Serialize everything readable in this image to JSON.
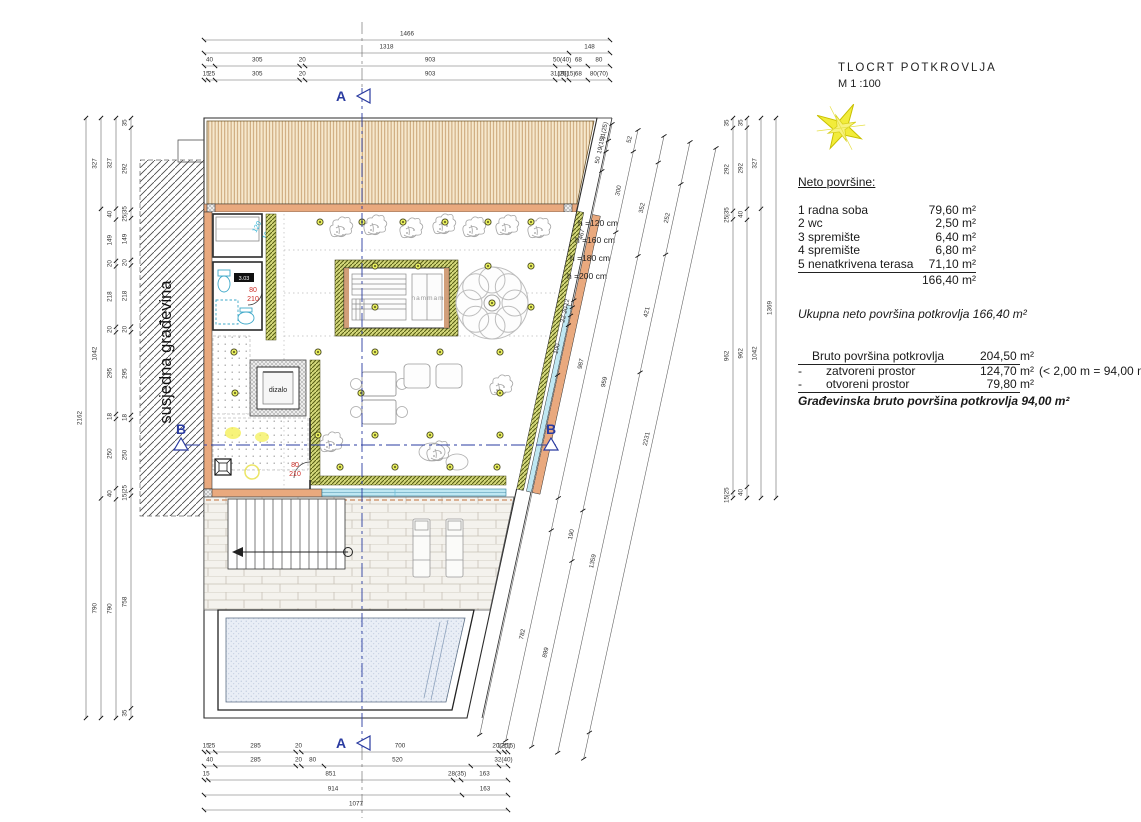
{
  "title_block": {
    "title": "TLOCRT POTKROVLJA",
    "scale": "M 1 :100"
  },
  "neto": {
    "heading": "Neto površine:",
    "rows": [
      {
        "name": "1 radna soba",
        "value": "79,60 m²"
      },
      {
        "name": "2 wc",
        "value": "2,50 m²"
      },
      {
        "name": "3 spremište",
        "value": "6,40 m²"
      },
      {
        "name": "4 spremište",
        "value": "6,80 m²"
      },
      {
        "name": "5 nenatkrivena terasa",
        "value": "71,10 m²"
      }
    ],
    "total": "166,40 m²",
    "summary": "Ukupna neto površina  potkrovlja  166,40 m²"
  },
  "bruto": {
    "rows": [
      {
        "bullet": "",
        "name": "Bruto površina potkrovlja",
        "value": "204,50 m²",
        "note": ""
      },
      {
        "bullet": "-",
        "name": "zatvoreni prostor",
        "value": "124,70 m²",
        "note": "(< 2,00 m = 94,00 m²)"
      },
      {
        "bullet": "-",
        "name": "otvoreni prostor",
        "value": "79,80 m²",
        "note": ""
      }
    ],
    "final": "Građevinska bruto površina potkrovlja  94,00 m²"
  },
  "plan": {
    "labels": {
      "neighbor": "susjedna građevina",
      "elevator": "dizalo",
      "hammam": "hammam",
      "room_no": "3.03",
      "door1_w": "80",
      "door1_h": "210",
      "door2_w": "80",
      "door2_h": "210",
      "window_w": "120",
      "window_h": "100"
    },
    "heights": [
      "h =120 cm",
      "h =160 cm",
      "h =180 cm",
      "h =200 cm"
    ],
    "sections": {
      "a": "A",
      "b": "B"
    }
  },
  "colors": {
    "wall_orange": "#e9a97e",
    "wall_green": "#d5d97c",
    "glass_cyan": "#bfe7f2",
    "section_blue": "#2a3ba0",
    "door_red": "#cc2b24",
    "light_yellow": "#e8ef5e",
    "star_yellow": "#f2ec3a"
  },
  "dims": {
    "top": [
      {
        "segs": [
          [
            "1466",
            1466
          ]
        ]
      },
      {
        "segs": [
          [
            "1318",
            1318
          ],
          [
            "148",
            148
          ]
        ]
      },
      {
        "segs": [
          [
            "40",
            40
          ],
          [
            "305",
            305
          ],
          [
            "20",
            20
          ],
          [
            "903",
            903
          ],
          [
            "50(40)",
            50
          ],
          [
            "68",
            68
          ],
          [
            "80",
            80
          ]
        ]
      },
      {
        "segs": [
          [
            "15",
            15
          ],
          [
            "25",
            25
          ],
          [
            "305",
            305
          ],
          [
            "20",
            20
          ],
          [
            "903",
            903
          ],
          [
            "31(25)",
            31
          ],
          [
            "19(15)",
            19
          ],
          [
            "68",
            68
          ],
          [
            "80(70)",
            80
          ]
        ]
      }
    ],
    "bottom": [
      {
        "segs": [
          [
            "15",
            15
          ],
          [
            "25",
            25
          ],
          [
            "285",
            285
          ],
          [
            "20",
            20
          ],
          [
            "700",
            700
          ],
          [
            "20(25)",
            20
          ],
          [
            "12(15)",
            13
          ]
        ]
      },
      {
        "segs": [
          [
            "40",
            40
          ],
          [
            "285",
            285
          ],
          [
            "20",
            20
          ],
          [
            "80",
            80
          ],
          [
            "520",
            520
          ],
          [
            "",
            100
          ],
          [
            "32(40)",
            32
          ]
        ]
      },
      {
        "segs": [
          [
            "15",
            15
          ],
          [
            "851",
            851
          ],
          [
            "28(35)",
            28
          ],
          [
            "163",
            163
          ]
        ]
      },
      {
        "segs": [
          [
            "914",
            914
          ],
          [
            "163",
            163
          ]
        ]
      },
      {
        "segs": [
          [
            "1077",
            1077
          ]
        ]
      }
    ],
    "left": [
      {
        "segs": [
          [
            "2162",
            2162
          ]
        ]
      },
      {
        "segs": [
          [
            "327",
            327
          ],
          [
            "1042",
            1042
          ],
          [
            "790",
            790
          ]
        ]
      },
      {
        "segs": [
          [
            "327",
            327
          ],
          [
            "40",
            40
          ],
          [
            "149",
            149
          ],
          [
            "20",
            20
          ],
          [
            "218",
            218
          ],
          [
            "20",
            20
          ],
          [
            "295",
            295
          ],
          [
            "18",
            18
          ],
          [
            "250",
            250
          ],
          [
            "40",
            40
          ],
          [
            "790",
            790
          ]
        ]
      },
      {
        "segs": [
          [
            "35",
            35
          ],
          [
            "292",
            292
          ],
          [
            "25|35",
            30
          ],
          [
            "149",
            149
          ],
          [
            "20",
            20
          ],
          [
            "218",
            218
          ],
          [
            "20",
            20
          ],
          [
            "295",
            295
          ],
          [
            "18",
            18
          ],
          [
            "250",
            250
          ],
          [
            "15|25",
            20
          ],
          [
            "758",
            758
          ],
          [
            "35",
            35
          ]
        ]
      }
    ],
    "right": [
      {
        "segs": [
          [
            "35",
            35
          ],
          [
            "292",
            292
          ],
          [
            "25|35",
            30
          ],
          [
            "962",
            962
          ],
          [
            "15|25",
            20
          ]
        ]
      },
      {
        "segs": [
          [
            "35",
            35
          ],
          [
            "292",
            292
          ],
          [
            "40",
            40
          ],
          [
            "962",
            962
          ],
          [
            "40",
            40
          ]
        ]
      },
      {
        "segs": [
          [
            "327",
            327
          ],
          [
            "1042",
            1042
          ]
        ]
      },
      {
        "segs": [
          [
            "1369",
            1369
          ]
        ]
      }
    ],
    "diag": [
      {
        "segs": [
          [
            "31(25)",
            60
          ],
          [
            "19(15)",
            40
          ],
          [
            "50",
            70
          ],
          [
            "467",
            467
          ],
          [
            "12",
            25
          ],
          [
            "20",
            30
          ],
          [
            "22",
            35
          ],
          [
            "100",
            180
          ],
          [
            "",
            1300
          ]
        ]
      },
      {
        "segs": [
          [
            "52",
            80
          ],
          [
            "300",
            300
          ],
          [
            "987",
            987
          ],
          [
            "",
            120
          ],
          [
            "782",
            782
          ]
        ]
      },
      {
        "segs": [
          [
            "",
            100
          ],
          [
            "352",
            352
          ],
          [
            "959",
            959
          ],
          [
            "190",
            190
          ],
          [
            "899",
            700
          ]
        ]
      },
      {
        "segs": [
          [
            "",
            150
          ],
          [
            "252",
            252
          ],
          [
            "421",
            421
          ],
          [
            "1359",
            1359
          ]
        ]
      },
      {
        "segs": [
          [
            "2231",
            2231
          ],
          [
            "",
            100
          ]
        ]
      }
    ]
  }
}
